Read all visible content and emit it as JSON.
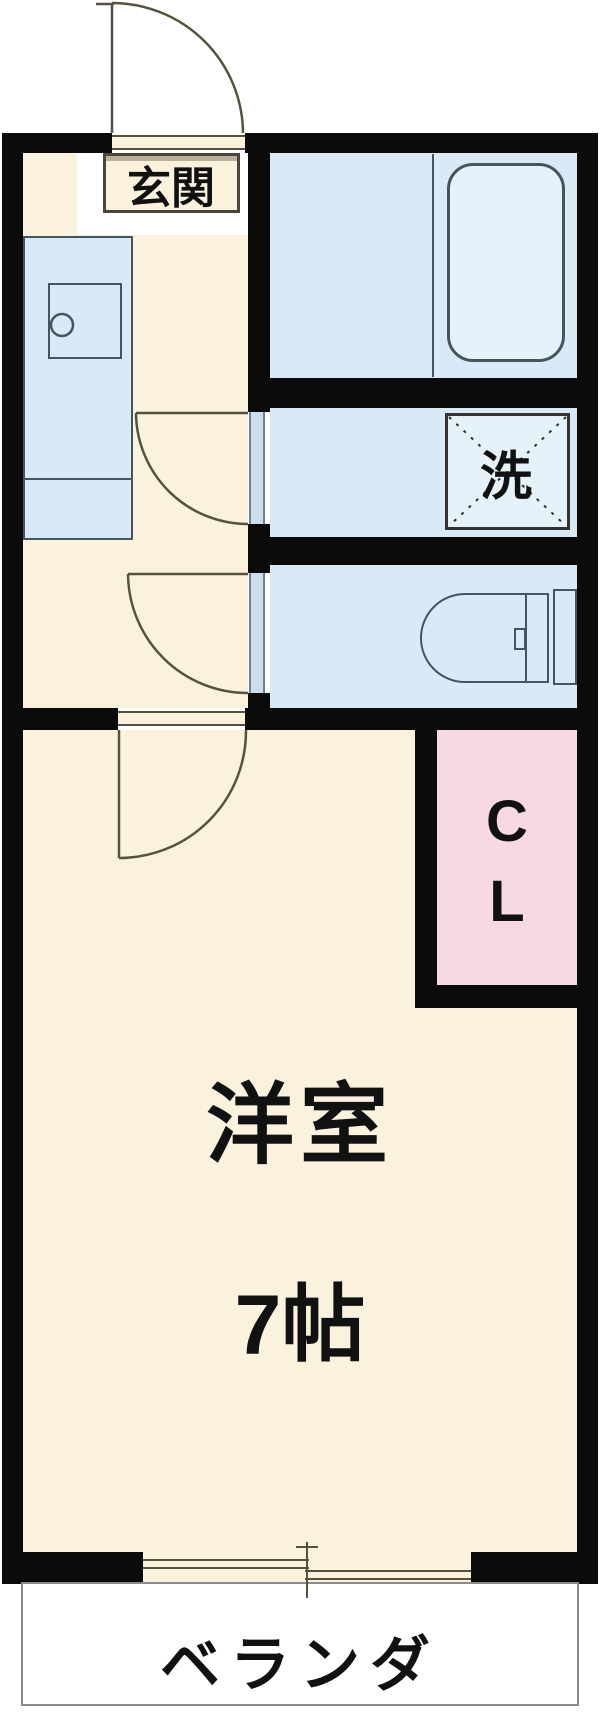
{
  "rooms": {
    "entrance": {
      "label": "玄関"
    },
    "laundry": {
      "label": "洗"
    },
    "closet": {
      "line1": "C",
      "line2": "L"
    },
    "main_room": {
      "name": "洋室",
      "size": "7帖"
    },
    "balcony": {
      "label": "ベランダ"
    }
  },
  "colors": {
    "wall": "#0b0b0b",
    "floor": "#fbf2de",
    "water": "#d9eaf6",
    "water_light": "#e6f2fa",
    "closet_pink": "#f8d8e1",
    "door_line": "#57513f",
    "fixture_line": "#44555e",
    "balcony_border": "#8b8b8b",
    "label": "#111111",
    "bg": "#ffffff",
    "threshold": "#cddded"
  }
}
